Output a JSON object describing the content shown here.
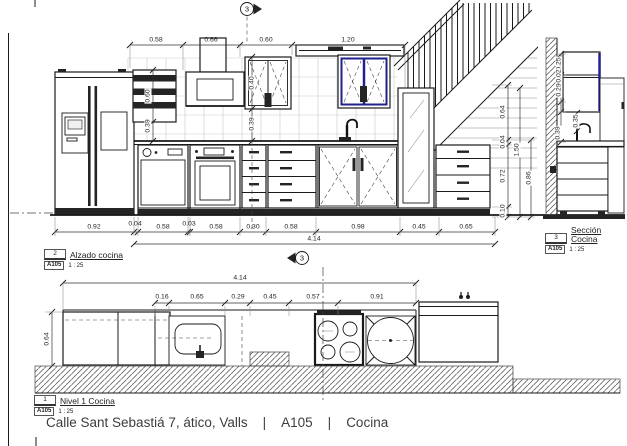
{
  "footer": {
    "address": "Calle Sant Sebastiá 7, ático, Valls",
    "sheet": "A105",
    "room": "Cocina",
    "sep": "|"
  },
  "views": {
    "elevation": {
      "label": {
        "num": "2",
        "title": "Alzado cocina",
        "sheet": "A105",
        "scale": "1 : 25"
      },
      "marker": "3",
      "dims_top": [
        "0.58",
        "0.66",
        "0.60",
        "1.20"
      ],
      "dims_bottom": [
        "0.92",
        "0.04",
        "0.58",
        "0.03",
        "0.58",
        "0.30",
        "0.58",
        "0.98",
        "0.45",
        "0.65"
      ],
      "dim_total": "4.14",
      "dims_right": [
        "0.64",
        "0.04",
        "0.72",
        "0.10"
      ],
      "dims_right_overall": [
        "1.50",
        "0.86"
      ],
      "dims_wall": [
        "0.60",
        "0.39",
        "0.40",
        "0.39"
      ]
    },
    "section": {
      "label": {
        "num": "3",
        "title": "Sección Cocina",
        "sheet": "A105",
        "scale": "1 : 25"
      },
      "dims": [
        "0.25",
        "0.02",
        "0.29",
        "0.35",
        "0.39"
      ]
    },
    "plan": {
      "label": {
        "num": "1",
        "title": "Nivel 1 Cocina",
        "sheet": "A105",
        "scale": "1 : 25"
      },
      "marker": "3",
      "dim_total": "4.14",
      "dims_row": [
        "0.16",
        "0.65",
        "0.29",
        "0.45",
        "0.57",
        "0.91"
      ],
      "dim_depth": "0.64"
    }
  }
}
